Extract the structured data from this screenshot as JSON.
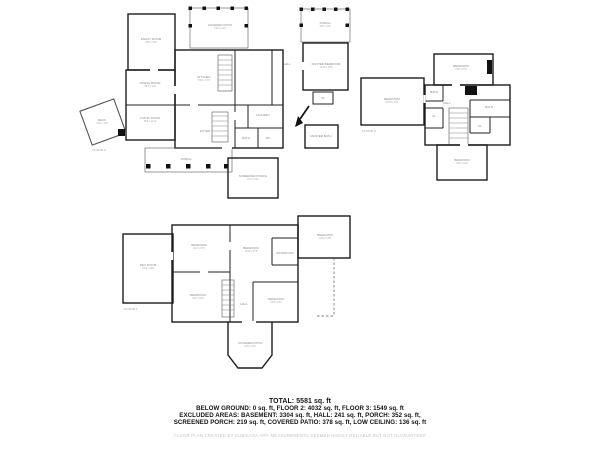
{
  "page": {
    "background": "#ffffff",
    "wall_color": "#1c1c1c",
    "label_color": "#8a8a8a",
    "disclaimer_color": "#c4c4c4"
  },
  "summary": {
    "total": "TOTAL: 5581 sq. ft",
    "line1": "BELOW GROUND: 0 sq. ft, FLOOR 2: 4032 sq. ft, FLOOR 3: 1549 sq. ft",
    "line2": "EXCLUDED AREAS: BASEMENT: 3304 sq. ft, HALL: 241 sq. ft, PORCH: 352 sq. ft,",
    "line3": "SCREENED PORCH: 219 sq. ft, COVERED PATIO: 378 sq. ft, LOW CEILING: 136 sq. ft",
    "disclaimer": "FLOOR PLAN CREATED BY CUBICASA APP. MEASUREMENTS DEEMED HIGHLY RELIABLE BUT NOT GUARANTEED"
  },
  "floors": [
    {
      "id": "floor2",
      "caption": "FLOOR 2",
      "caption_pos": {
        "x": 99,
        "y": 151
      },
      "rooms": [
        {
          "label": "FAMILY ROOM",
          "dims": "15'8 x 19'2",
          "x": 151,
          "y": 40
        },
        {
          "label": "DINING ROOM",
          "dims": "15'4 x 11'6",
          "x": 150,
          "y": 84
        },
        {
          "label": "LIVING ROOM",
          "dims": "15'4 x 11'10",
          "x": 150,
          "y": 119
        },
        {
          "label": "KITCHEN",
          "dims": "19'6 x 17'2",
          "x": 204,
          "y": 78
        },
        {
          "label": "FOYER",
          "x": 205,
          "y": 132
        },
        {
          "label": "HALL",
          "x": 287,
          "y": 65
        },
        {
          "label": "LAUNDRY",
          "x": 263,
          "y": 116
        },
        {
          "label": "BATH",
          "x": 246,
          "y": 139
        },
        {
          "label": "WC",
          "x": 268,
          "y": 139
        },
        {
          "label": "COVERED PATIO",
          "dims": "19'2 x 12'6",
          "x": 220,
          "y": 26
        },
        {
          "label": "PORCH",
          "dims": "16'0 x 11'0",
          "x": 325,
          "y": 24
        },
        {
          "label": "MASTER BEDROOM",
          "dims": "14'10 x 15'6",
          "x": 326,
          "y": 65
        },
        {
          "label": "CL",
          "x": 323,
          "y": 99
        },
        {
          "label": "MASTER BATH",
          "x": 321,
          "y": 137
        },
        {
          "label": "SCREENED PORCH",
          "dims": "16'4 x 13'2",
          "x": 253,
          "y": 177
        },
        {
          "label": "PORCH",
          "x": 186,
          "y": 160
        },
        {
          "label": "DECK",
          "dims": "12'0 x 11'6",
          "x": 102,
          "y": 121
        }
      ]
    },
    {
      "id": "floor3",
      "caption": "FLOOR 3",
      "caption_pos": {
        "x": 369,
        "y": 132
      },
      "rooms": [
        {
          "label": "BEDROOM",
          "dims": "20'10 x 15'4",
          "x": 392,
          "y": 100
        },
        {
          "label": "BEDROOM",
          "dims": "19'8 x 10'2",
          "x": 461,
          "y": 67
        },
        {
          "label": "BATH",
          "x": 434,
          "y": 93
        },
        {
          "label": "CL",
          "x": 434,
          "y": 117
        },
        {
          "label": "HALL",
          "x": 447,
          "y": 104
        },
        {
          "label": "BATH",
          "x": 489,
          "y": 108
        },
        {
          "label": "CL",
          "x": 480,
          "y": 127
        },
        {
          "label": "BEDROOM",
          "dims": "15'6 x 12'0",
          "x": 462,
          "y": 161
        }
      ]
    },
    {
      "id": "floor1",
      "caption": "FLOOR 1",
      "caption_pos": {
        "x": 131,
        "y": 310
      },
      "rooms": [
        {
          "label": "REC ROOM",
          "dims": "16'4 x 22'8",
          "x": 148,
          "y": 266
        },
        {
          "label": "BEDROOM",
          "dims": "19'2 x 15'4",
          "x": 199,
          "y": 246
        },
        {
          "label": "BEDROOM",
          "dims": "13'10 x 17'8",
          "x": 251,
          "y": 249
        },
        {
          "label": "BATHROOM",
          "x": 285,
          "y": 254
        },
        {
          "label": "BEDROOM",
          "dims": "19'2 x 16'6",
          "x": 198,
          "y": 296
        },
        {
          "label": "HALL",
          "x": 244,
          "y": 305
        },
        {
          "label": "BEDROOM",
          "dims": "14'8 x 12'4",
          "x": 276,
          "y": 300
        },
        {
          "label": "BEDROOM",
          "dims": "16'6 x 13'8",
          "x": 325,
          "y": 236
        },
        {
          "label": "COVERED PATIO",
          "dims": "14'6 x 15'2",
          "x": 250,
          "y": 344
        }
      ]
    }
  ]
}
